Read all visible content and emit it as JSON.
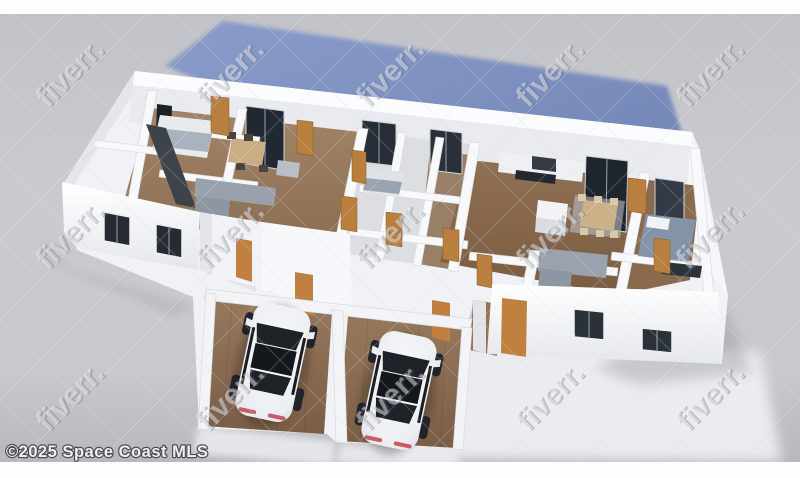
{
  "page": {
    "description": "3D dollhouse-style floor plan rendering of a multi-unit home with two garages and two white cars, roof removed, viewed from above"
  },
  "footer": {
    "copyright": "©2025 Space Coast MLS"
  },
  "watermark": {
    "text": "fiverr.",
    "rotation_deg": -45,
    "tiled": true
  },
  "scene": {
    "garages": 2,
    "cars": 2,
    "ground_plane_color_name": "slate blue"
  },
  "colors": {
    "background_gray": "#c7c8cd",
    "canvas_white": "#fefefe",
    "ground_plane_blue": "#7b8ec0",
    "wall_white": "#f7f8fa",
    "wall_shadow": "#d7dade",
    "wood_floor": "#8f7156",
    "wood_floor_light": "#9c7f63",
    "door_wood_orange": "#bf8343",
    "window_glass_dark": "#242a32",
    "sofa_gray": "#97a0aa",
    "car_body_white": "#f2f3f5",
    "car_glass": "#1d2126"
  }
}
